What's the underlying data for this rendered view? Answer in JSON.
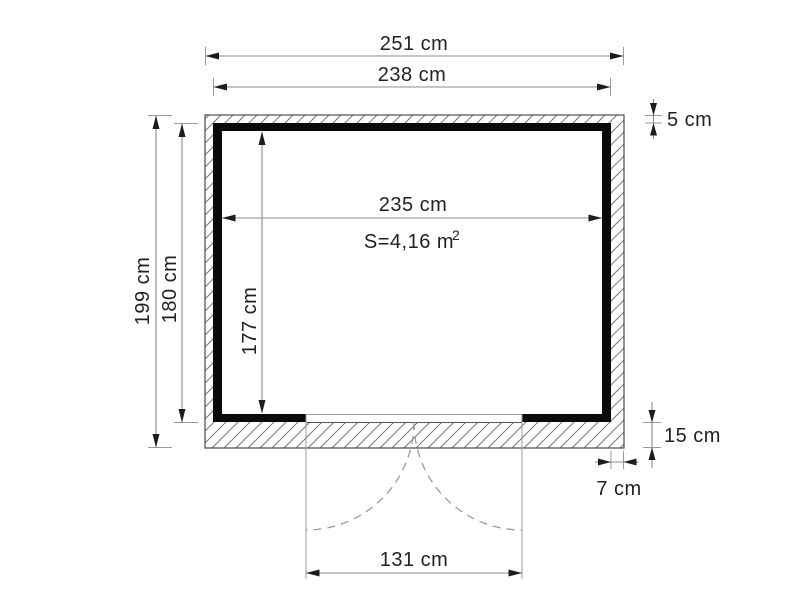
{
  "plan": {
    "type": "shed-floor-plan",
    "dims": {
      "overall_width": "251 cm",
      "wall_outer_width": "238 cm",
      "interior_width": "235 cm",
      "overall_depth": "199 cm",
      "wall_outer_depth": "180 cm",
      "interior_depth": "177 cm",
      "top_edge_offset": "5 cm",
      "bottom_edge_offset": "15 cm",
      "right_edge_offset": "7 cm",
      "door_width": "131 cm"
    },
    "area": {
      "text": "S=4,16 m",
      "superscript": "2"
    },
    "colors": {
      "wall": "#0a0a0a",
      "dimension_line": "#8c8c8c",
      "hatch_line": "#777777",
      "text": "#222222"
    }
  }
}
